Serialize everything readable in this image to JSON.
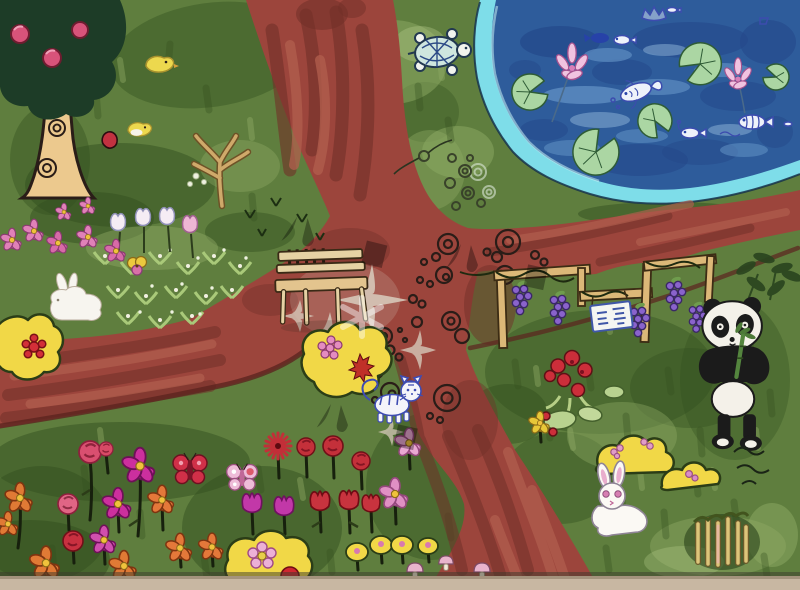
{
  "meta": {
    "type": "photograph of a child's marker painting",
    "scene": "aerial park map with crossing red paths, pond, flower gardens and animals"
  },
  "watermark": {
    "text": "儿童画网",
    "color": "#ffffff",
    "opacity": 0.32,
    "instances": 3
  },
  "palette": {
    "grass": "#5f7e3e",
    "grass-dark": "#33501f",
    "grass-light": "#8ea964",
    "path": "#9c453c",
    "path-dark": "#713028",
    "path-light": "#b25f4e",
    "path-pale": "#d6c8b9",
    "pond": "#2e5c9b",
    "pond-dark": "#24488a",
    "pond-light": "#5e8dc2",
    "pond-edge": "#7edde9",
    "lily": "#abd6a3",
    "lotus": "#f0c3e0",
    "tree-canopy": "#1d3c27",
    "trunk": "#ecc98e",
    "apple": "#d8537a",
    "bush": "#f1d847",
    "bush-stroke": "#2b3d17",
    "wood": "#e6d2a4",
    "panda-black": "#1b1b1b",
    "panda-white": "#f4f1e9",
    "grape": "#8a63cc",
    "ink": "#2a1d18",
    "blue-ink": "#3c4cae",
    "table": "#c8b7a2"
  },
  "scene": {
    "elements": [
      {
        "name": "apple-tree",
        "label": "apple tree with spiral-knot trunk"
      },
      {
        "name": "pond",
        "label": "blue pond with cyan shore"
      },
      {
        "name": "lotus-flowers",
        "label": "pink lotus blossoms"
      },
      {
        "name": "lily-pads",
        "label": "green lily pads"
      },
      {
        "name": "pond-fish",
        "label": "fish doodles in pond"
      },
      {
        "name": "turtle",
        "label": "turtle at pond shore"
      },
      {
        "name": "paths",
        "label": "crossing red-brown paths"
      },
      {
        "name": "stepping-stones",
        "label": "spiral stone doodles on path"
      },
      {
        "name": "bench",
        "label": "wooden bench"
      },
      {
        "name": "flower-bed-west",
        "label": "tulip and sprout bed"
      },
      {
        "name": "flower-field-south",
        "label": "colourful flower field"
      },
      {
        "name": "butterflies",
        "label": "two butterflies"
      },
      {
        "name": "mushrooms",
        "label": "pink mushrooms"
      },
      {
        "name": "yellow-bushes",
        "label": "yellow flowering bushes"
      },
      {
        "name": "grape-trellis",
        "label": "grape trellis with hanging sign"
      },
      {
        "name": "panda",
        "label": "panda eating bamboo"
      },
      {
        "name": "tiger-cub",
        "label": "blue-outlined tiger cub"
      },
      {
        "name": "rabbit-west",
        "label": "white rabbit in flower bed"
      },
      {
        "name": "rabbit-southeast",
        "label": "white rabbit with pink ears"
      },
      {
        "name": "chicks",
        "label": "yellow chicks"
      },
      {
        "name": "bare-tree",
        "label": "small bare tree"
      },
      {
        "name": "log-fence",
        "label": "little log fence"
      },
      {
        "name": "table-edge",
        "label": "table surface below paper"
      }
    ]
  }
}
